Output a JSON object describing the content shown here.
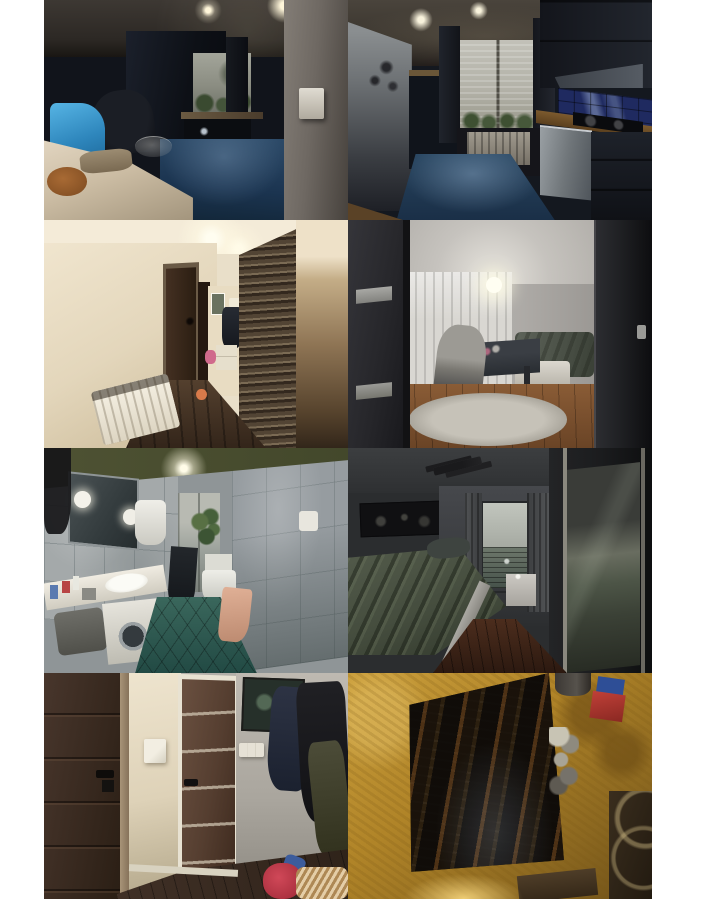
{
  "page": {
    "title": "Apartment interior photo gallery",
    "background_color": "#ffffff"
  },
  "gallery": {
    "rows": 4,
    "columns": 2,
    "photo_count": 8,
    "photos": [
      {
        "id": "kitchen-dining-view",
        "alt": "Dark kitchen seen from dining table: beige tablecloth with bread loaf and blue bag, office chair, navy cabinets, small bright window with plants, steel-blue floor, grey wall with light switch on the right",
        "dominant_colors": [
          "#11141b",
          "#24405c",
          "#d6cab6",
          "#3c9bd1"
        ]
      },
      {
        "id": "kitchen-galley-view",
        "alt": "Galley kitchen: grey fridge with magnets on the left, bright window with lace curtain and potted plants, dark curtains, radiator, cooker hood, blue tile splashback, wooden counter with hob, stainless dishwasher, reflective blue floor",
        "dominant_colors": [
          "#3f3a34",
          "#b3b2a8",
          "#1f2a60",
          "#27445f"
        ]
      },
      {
        "id": "hallway",
        "alt": "Hallway with cream walls, white radiator, dark brown doors, small picture and coat on far wall, shoe cabinet, pink toys, decorative dark stone feature wall on the right, dark wooden floor, ceiling spotlights",
        "dominant_colors": [
          "#e9dfc9",
          "#352419",
          "#473c30",
          "#33251a"
        ]
      },
      {
        "id": "bedroom-office",
        "alt": "Room viewed through open dark door: glowing ceiling lamp, white curtains, dark desk with grey office chair, bed with green-grey cover, white ottoman, shaggy grey rug on wooden floor, dark wardrobe edge on the right",
        "dominant_colors": [
          "#2c2c2e",
          "#c6c3be",
          "#d9d7d2",
          "#8a5c36"
        ]
      },
      {
        "id": "bathroom",
        "alt": "Bathroom with grey marble tiles, olive-green ceiling with spotlight, mirror with round lamps, white water heater, plant, toilet, white counter with sink and toiletries over washing machine, teal diagonal floor tiles, peach towel",
        "dominant_colors": [
          "#a4a9aa",
          "#4e5233",
          "#2e5a50",
          "#e0b096"
        ]
      },
      {
        "id": "bedroom-dark",
        "alt": "Dark bedroom: panorama picture on grey wall, track ceiling light, window with light roller blind and grey curtains, bed with rumpled green-grey bedding and white frame, small white nightstand, mirrored wardrobe reflecting the bed, dark red-brown floor",
        "dominant_colors": [
          "#2b2d2f",
          "#4a5244",
          "#c0c4bc",
          "#3c241a"
        ]
      },
      {
        "id": "entry-hall",
        "alt": "Entry hall: dark brown door with black handle on the left, cream wall with light switch, brown panel door with white frame and glass strips, framed dark picture, triple switch, hanging dark coats, dark floor with red bag and beige blanket",
        "dominant_colors": [
          "#392a20",
          "#ece2cc",
          "#b3afa8",
          "#c04050"
        ]
      },
      {
        "id": "attic-hatch",
        "alt": "View up through a rough mustard-yellow plastered hatch into a dark attic with wooden rafters, stored jars and cans, a red box and blue box on the ledge, dark metal rack at bottom right, warm light glow below",
        "dominant_colors": [
          "#c89c38",
          "#17130e",
          "#c04038",
          "#2e4e96"
        ]
      }
    ]
  }
}
